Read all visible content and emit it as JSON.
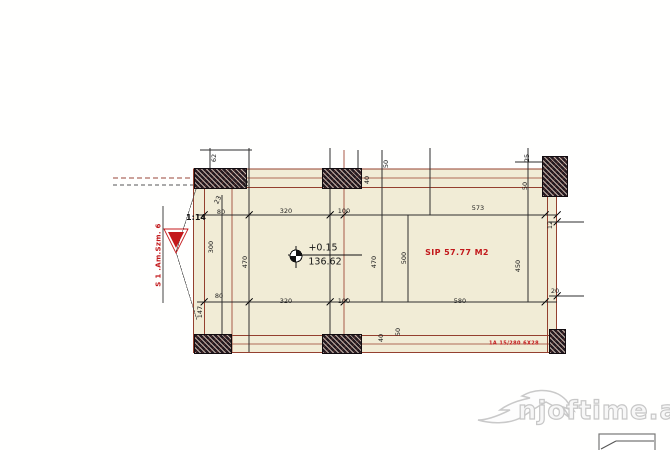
{
  "plan": {
    "area_label": "SIP 57.77 M2",
    "section_label": "S 1 .Am.Szm. 6",
    "scale_note": "1:14",
    "level": {
      "top": "+0.15",
      "bottom": "136.62"
    },
    "detail_note": "1A 15/280 6X28",
    "colors": {
      "room_fill": "#f1ecd6",
      "wall": "#94402f",
      "column": "#241a20",
      "dimension_text": "#1e1e1e",
      "red_annotation": "#c2181b"
    },
    "dims": [
      {
        "t": "62",
        "x": 214,
        "y": 158,
        "r": -90
      },
      {
        "t": "40",
        "x": 246,
        "y": 184,
        "r": -90
      },
      {
        "t": "23",
        "x": 218,
        "y": 200,
        "r": -65
      },
      {
        "t": "80",
        "x": 221,
        "y": 212,
        "r": 0
      },
      {
        "t": "300",
        "x": 211,
        "y": 247,
        "r": -90
      },
      {
        "t": "80",
        "x": 219,
        "y": 296,
        "r": 0
      },
      {
        "t": "147",
        "x": 200,
        "y": 312,
        "r": -90
      },
      {
        "t": "470",
        "x": 245,
        "y": 262,
        "r": -90
      },
      {
        "t": "470",
        "x": 374,
        "y": 262,
        "r": -90
      },
      {
        "t": "500",
        "x": 404,
        "y": 258,
        "r": -90
      },
      {
        "t": "450",
        "x": 518,
        "y": 266,
        "r": -90
      },
      {
        "t": "320",
        "x": 286,
        "y": 211,
        "r": 0
      },
      {
        "t": "100",
        "x": 344,
        "y": 211,
        "r": 0
      },
      {
        "t": "573",
        "x": 478,
        "y": 208,
        "r": 0
      },
      {
        "t": "320",
        "x": 286,
        "y": 301,
        "r": 0
      },
      {
        "t": "100",
        "x": 344,
        "y": 301,
        "r": 0
      },
      {
        "t": "580",
        "x": 460,
        "y": 301,
        "r": 0
      },
      {
        "t": "40",
        "x": 367,
        "y": 180,
        "r": -90
      },
      {
        "t": "50",
        "x": 386,
        "y": 164,
        "r": -90
      },
      {
        "t": "25",
        "x": 527,
        "y": 158,
        "r": -90
      },
      {
        "t": "50",
        "x": 525,
        "y": 186,
        "r": -90
      },
      {
        "t": "12",
        "x": 550,
        "y": 225,
        "r": -90
      },
      {
        "t": "20",
        "x": 555,
        "y": 291,
        "r": 0
      },
      {
        "t": "40",
        "x": 381,
        "y": 338,
        "r": -90
      },
      {
        "t": "50",
        "x": 398,
        "y": 332,
        "r": -90
      }
    ]
  },
  "watermark": {
    "text": "njoftime.al"
  }
}
